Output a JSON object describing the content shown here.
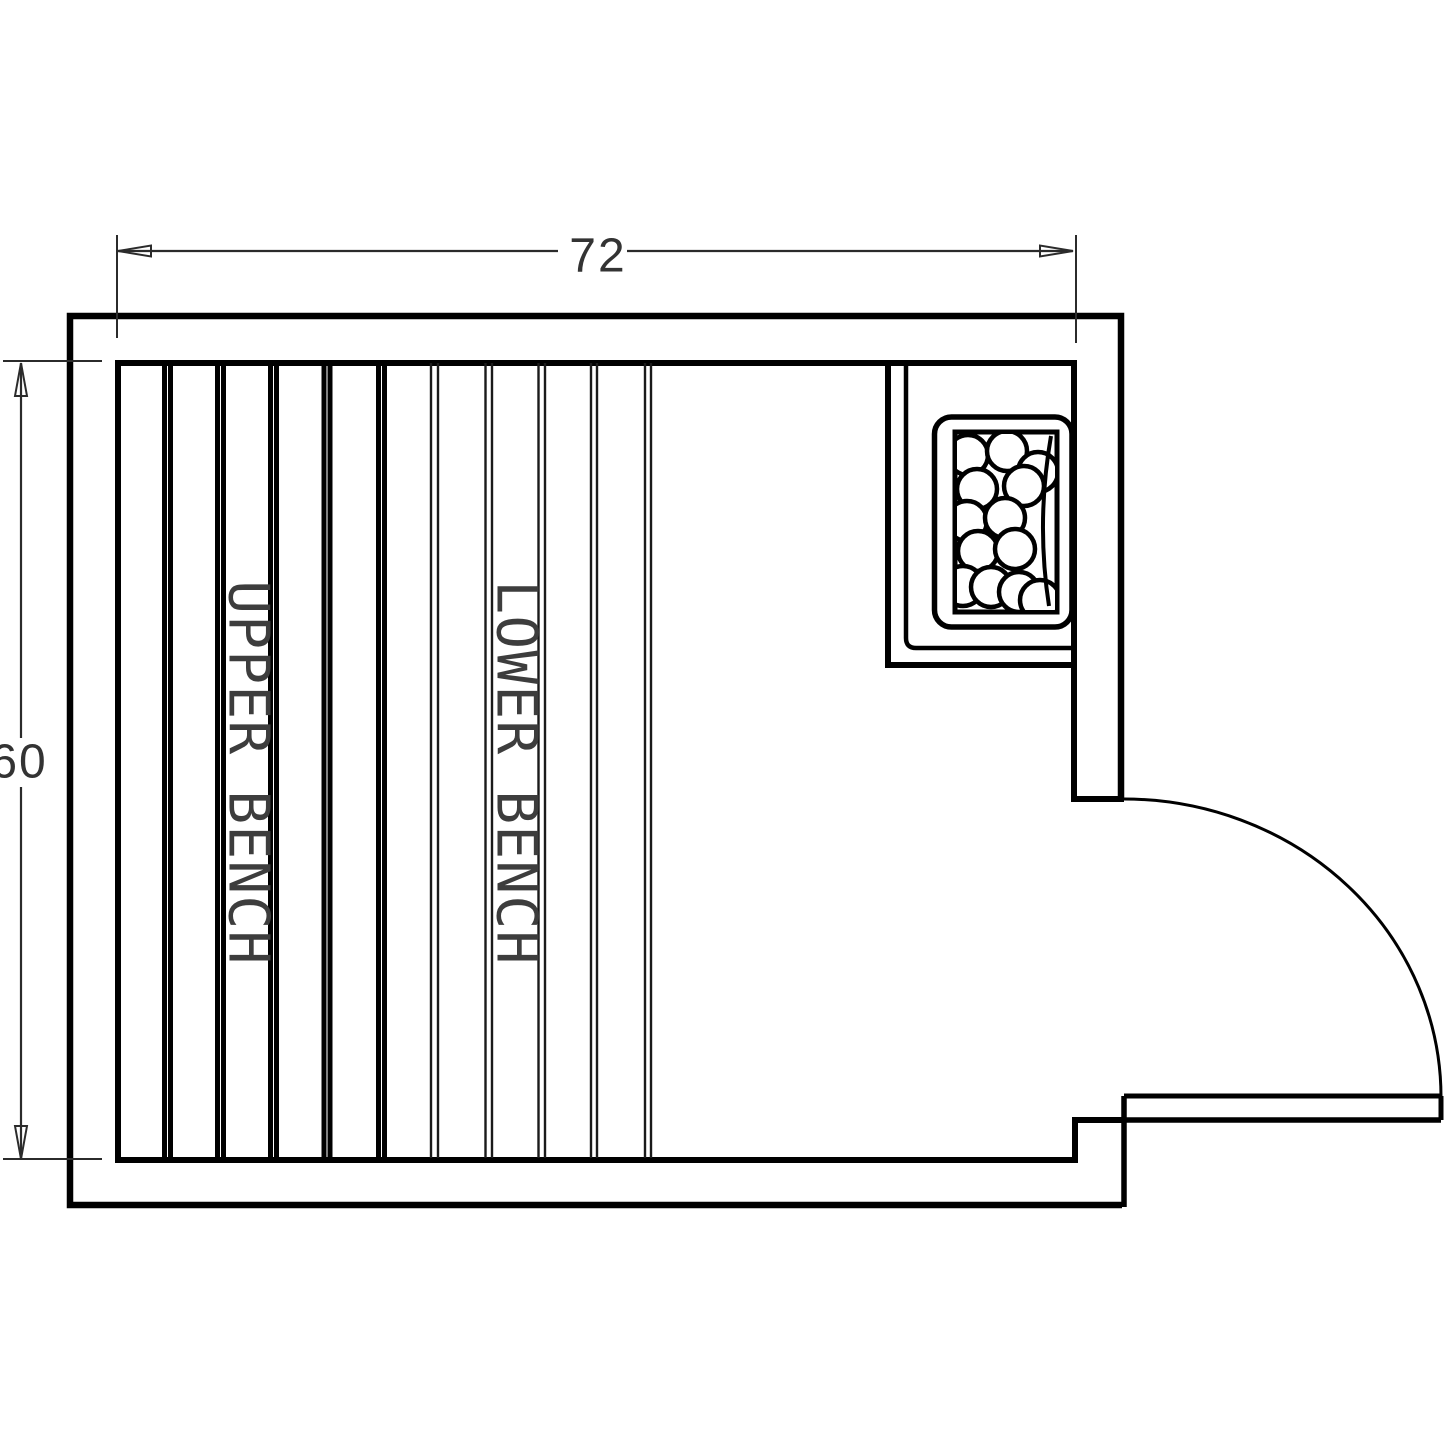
{
  "drawing": {
    "title": "sauna-room-floor-plan",
    "colors": {
      "background": "#ffffff",
      "line": "#000000",
      "dimension_text": "#333333",
      "bench_text": "#3d3d3d"
    },
    "dimensions": {
      "width": {
        "value": "72"
      },
      "height": {
        "value": "60"
      }
    },
    "labels": {
      "upper_bench": "UPPER BENCH",
      "lower_bench": "LOWER BENCH"
    }
  }
}
